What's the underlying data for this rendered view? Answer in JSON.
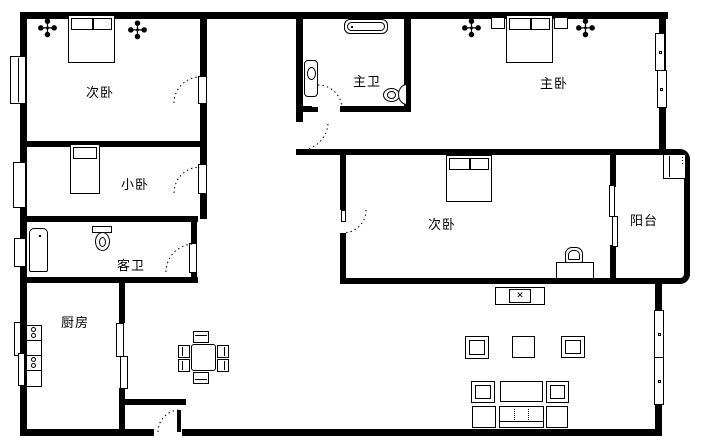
{
  "plan": {
    "background": "#ffffff",
    "wall_color": "#000000",
    "rooms": [
      {
        "name": "secondary-bedroom-top-left",
        "label": "次卧"
      },
      {
        "name": "master-bathroom",
        "label": "主卫"
      },
      {
        "name": "master-bedroom",
        "label": "主卧"
      },
      {
        "name": "small-bedroom",
        "label": "小卧"
      },
      {
        "name": "guest-bathroom",
        "label": "客卫"
      },
      {
        "name": "secondary-bedroom-center",
        "label": "次卧"
      },
      {
        "name": "balcony",
        "label": "阳台"
      },
      {
        "name": "kitchen",
        "label": "厨房"
      }
    ],
    "icons": {
      "plant": "✣",
      "tv_screen": "✕"
    }
  }
}
